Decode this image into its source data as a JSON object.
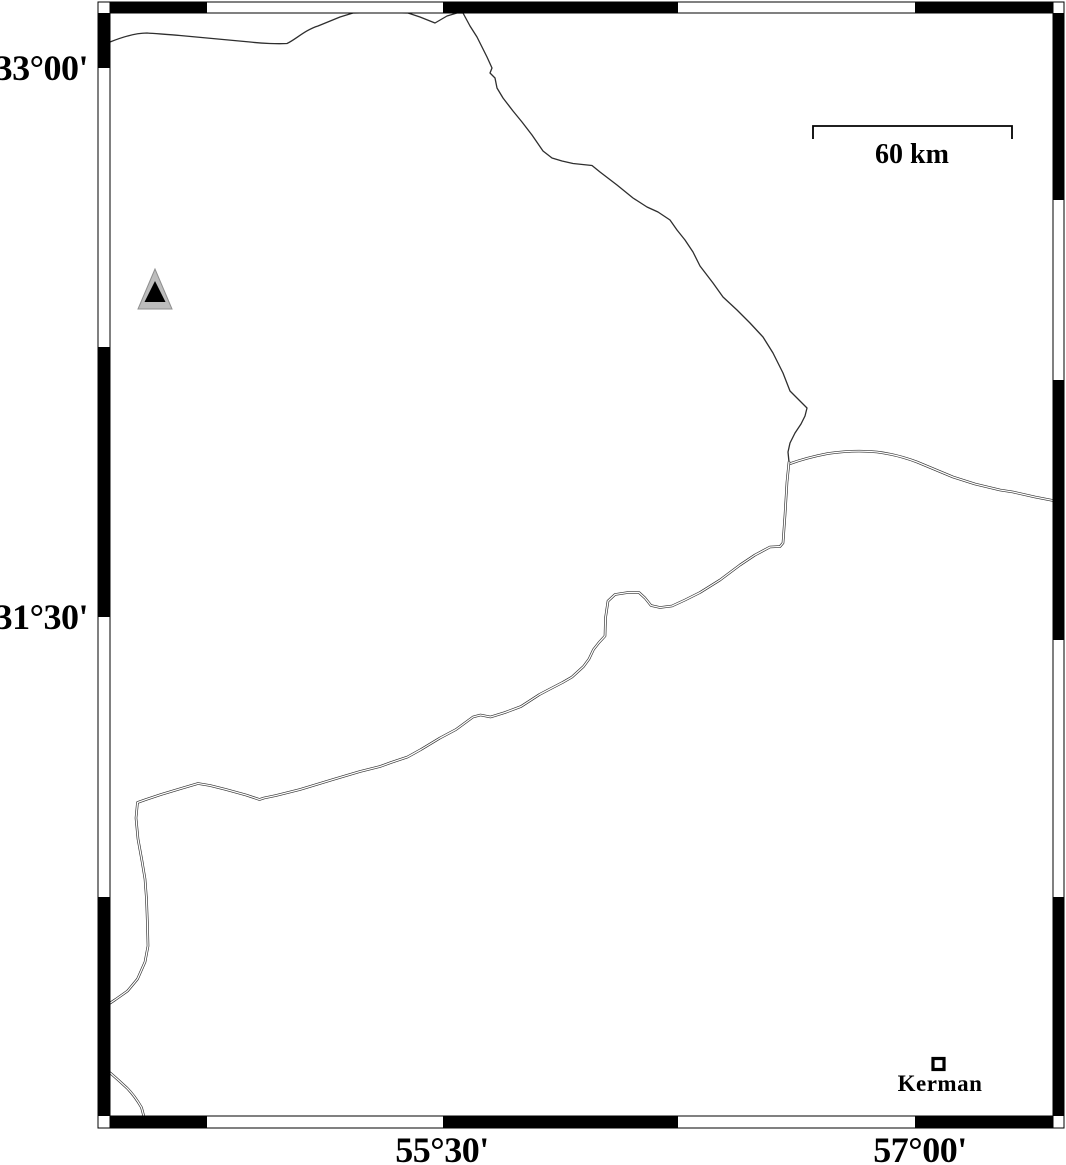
{
  "figure": {
    "type": "map",
    "axes": {
      "left": [
        {
          "label": "33°00'"
        },
        {
          "label": "31°30'"
        }
      ],
      "bottom": [
        {
          "label": "55°30'"
        },
        {
          "label": "57°00'"
        }
      ]
    },
    "scale_bar": {
      "label": "60 km"
    },
    "markers": {
      "city": {
        "label": "Kerman",
        "symbol": "square"
      },
      "triangle": {
        "symbol": "triangle"
      }
    },
    "colors": {
      "ink": "#000000",
      "boundary_line": "#2e2e2e",
      "triangle_gray": "#bdbdbd",
      "background": "#ffffff"
    }
  }
}
